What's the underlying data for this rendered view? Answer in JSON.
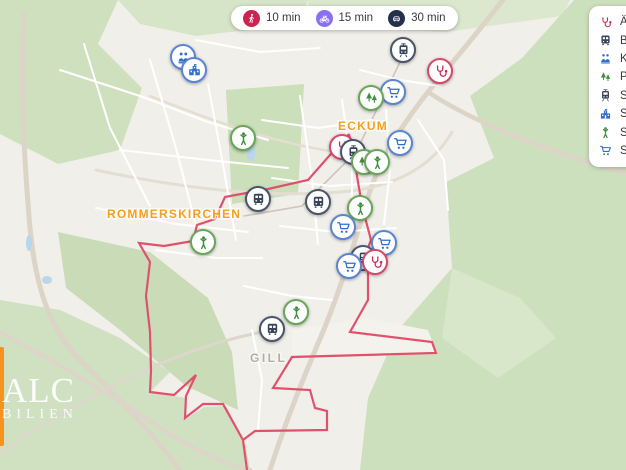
{
  "travel_times": {
    "items": [
      {
        "id": "walk",
        "label": "10 min",
        "icon": "walk",
        "color": "#CC2450"
      },
      {
        "id": "bike",
        "label": "15 min",
        "icon": "bike",
        "color": "#8A70EE"
      },
      {
        "id": "drive",
        "label": "30 min",
        "icon": "car",
        "color": "#25304A"
      }
    ]
  },
  "poi_legend": {
    "items": [
      {
        "id": "doctors",
        "label": "Ärz",
        "icon": "stethoscope",
        "color": "red"
      },
      {
        "id": "bus",
        "label": "Bu",
        "icon": "bus",
        "color": "dark"
      },
      {
        "id": "kindergarten",
        "label": "Kin",
        "icon": "kindergarten",
        "color": "blue"
      },
      {
        "id": "park",
        "label": "Pa",
        "icon": "trees",
        "color": "green"
      },
      {
        "id": "rail",
        "label": "Sc",
        "icon": "tram",
        "color": "dark"
      },
      {
        "id": "school",
        "label": "Sc",
        "icon": "school",
        "color": "blue"
      },
      {
        "id": "playground",
        "label": "Sp",
        "icon": "person",
        "color": "green"
      },
      {
        "id": "supermarket",
        "label": "Su",
        "icon": "cart",
        "color": "blue"
      }
    ]
  },
  "map": {
    "town_labels": {
      "eckum": "ECKUM",
      "rommerskirchen": "ROMMERSKIRCHEN",
      "gill": "GILL"
    },
    "boundary_color": "#E0516E",
    "markers": [
      {
        "type": "kindergarten",
        "color": "blue",
        "x": 183,
        "y": 57
      },
      {
        "type": "school",
        "color": "blue",
        "x": 194,
        "y": 70
      },
      {
        "type": "tram",
        "color": "dark",
        "x": 403,
        "y": 50
      },
      {
        "type": "stethoscope",
        "color": "red",
        "x": 440,
        "y": 71
      },
      {
        "type": "cart",
        "color": "blue",
        "x": 393,
        "y": 92
      },
      {
        "type": "trees",
        "color": "green",
        "x": 371,
        "y": 98
      },
      {
        "type": "person",
        "color": "green",
        "x": 243,
        "y": 138
      },
      {
        "type": "stethoscope",
        "color": "red",
        "x": 342,
        "y": 147
      },
      {
        "type": "tram",
        "color": "dark",
        "x": 353,
        "y": 152
      },
      {
        "type": "trees",
        "color": "green",
        "x": 364,
        "y": 162
      },
      {
        "type": "person",
        "color": "green",
        "x": 377,
        "y": 162
      },
      {
        "type": "cart",
        "color": "blue",
        "x": 400,
        "y": 143
      },
      {
        "type": "bus",
        "color": "dark",
        "x": 258,
        "y": 199
      },
      {
        "type": "bus",
        "color": "dark",
        "x": 318,
        "y": 202
      },
      {
        "type": "person",
        "color": "green",
        "x": 360,
        "y": 208
      },
      {
        "type": "cart",
        "color": "blue",
        "x": 343,
        "y": 227
      },
      {
        "type": "cart",
        "color": "blue",
        "x": 384,
        "y": 243
      },
      {
        "type": "machine",
        "color": "dark",
        "x": 363,
        "y": 258
      },
      {
        "type": "stethoscope",
        "color": "red",
        "x": 375,
        "y": 262
      },
      {
        "type": "cart",
        "color": "blue",
        "x": 349,
        "y": 266
      },
      {
        "type": "person",
        "color": "green",
        "x": 203,
        "y": 242
      },
      {
        "type": "person",
        "color": "green",
        "x": 296,
        "y": 312
      },
      {
        "type": "bus",
        "color": "dark",
        "x": 272,
        "y": 329
      }
    ]
  },
  "logo": {
    "line1": "ALC",
    "line2": "BILIEN",
    "bar_color": "#F6921E"
  },
  "colors": {
    "boundary": "#E0516E",
    "label_orange": "#F5A01D",
    "marker_red": "#CC2450",
    "marker_dark": "#39445A",
    "marker_blue": "#2F6FC7",
    "marker_green": "#3F8E3F",
    "map_green": "#CFE0BF",
    "map_urban": "#F1EFE9",
    "water": "#B9D6EA"
  }
}
